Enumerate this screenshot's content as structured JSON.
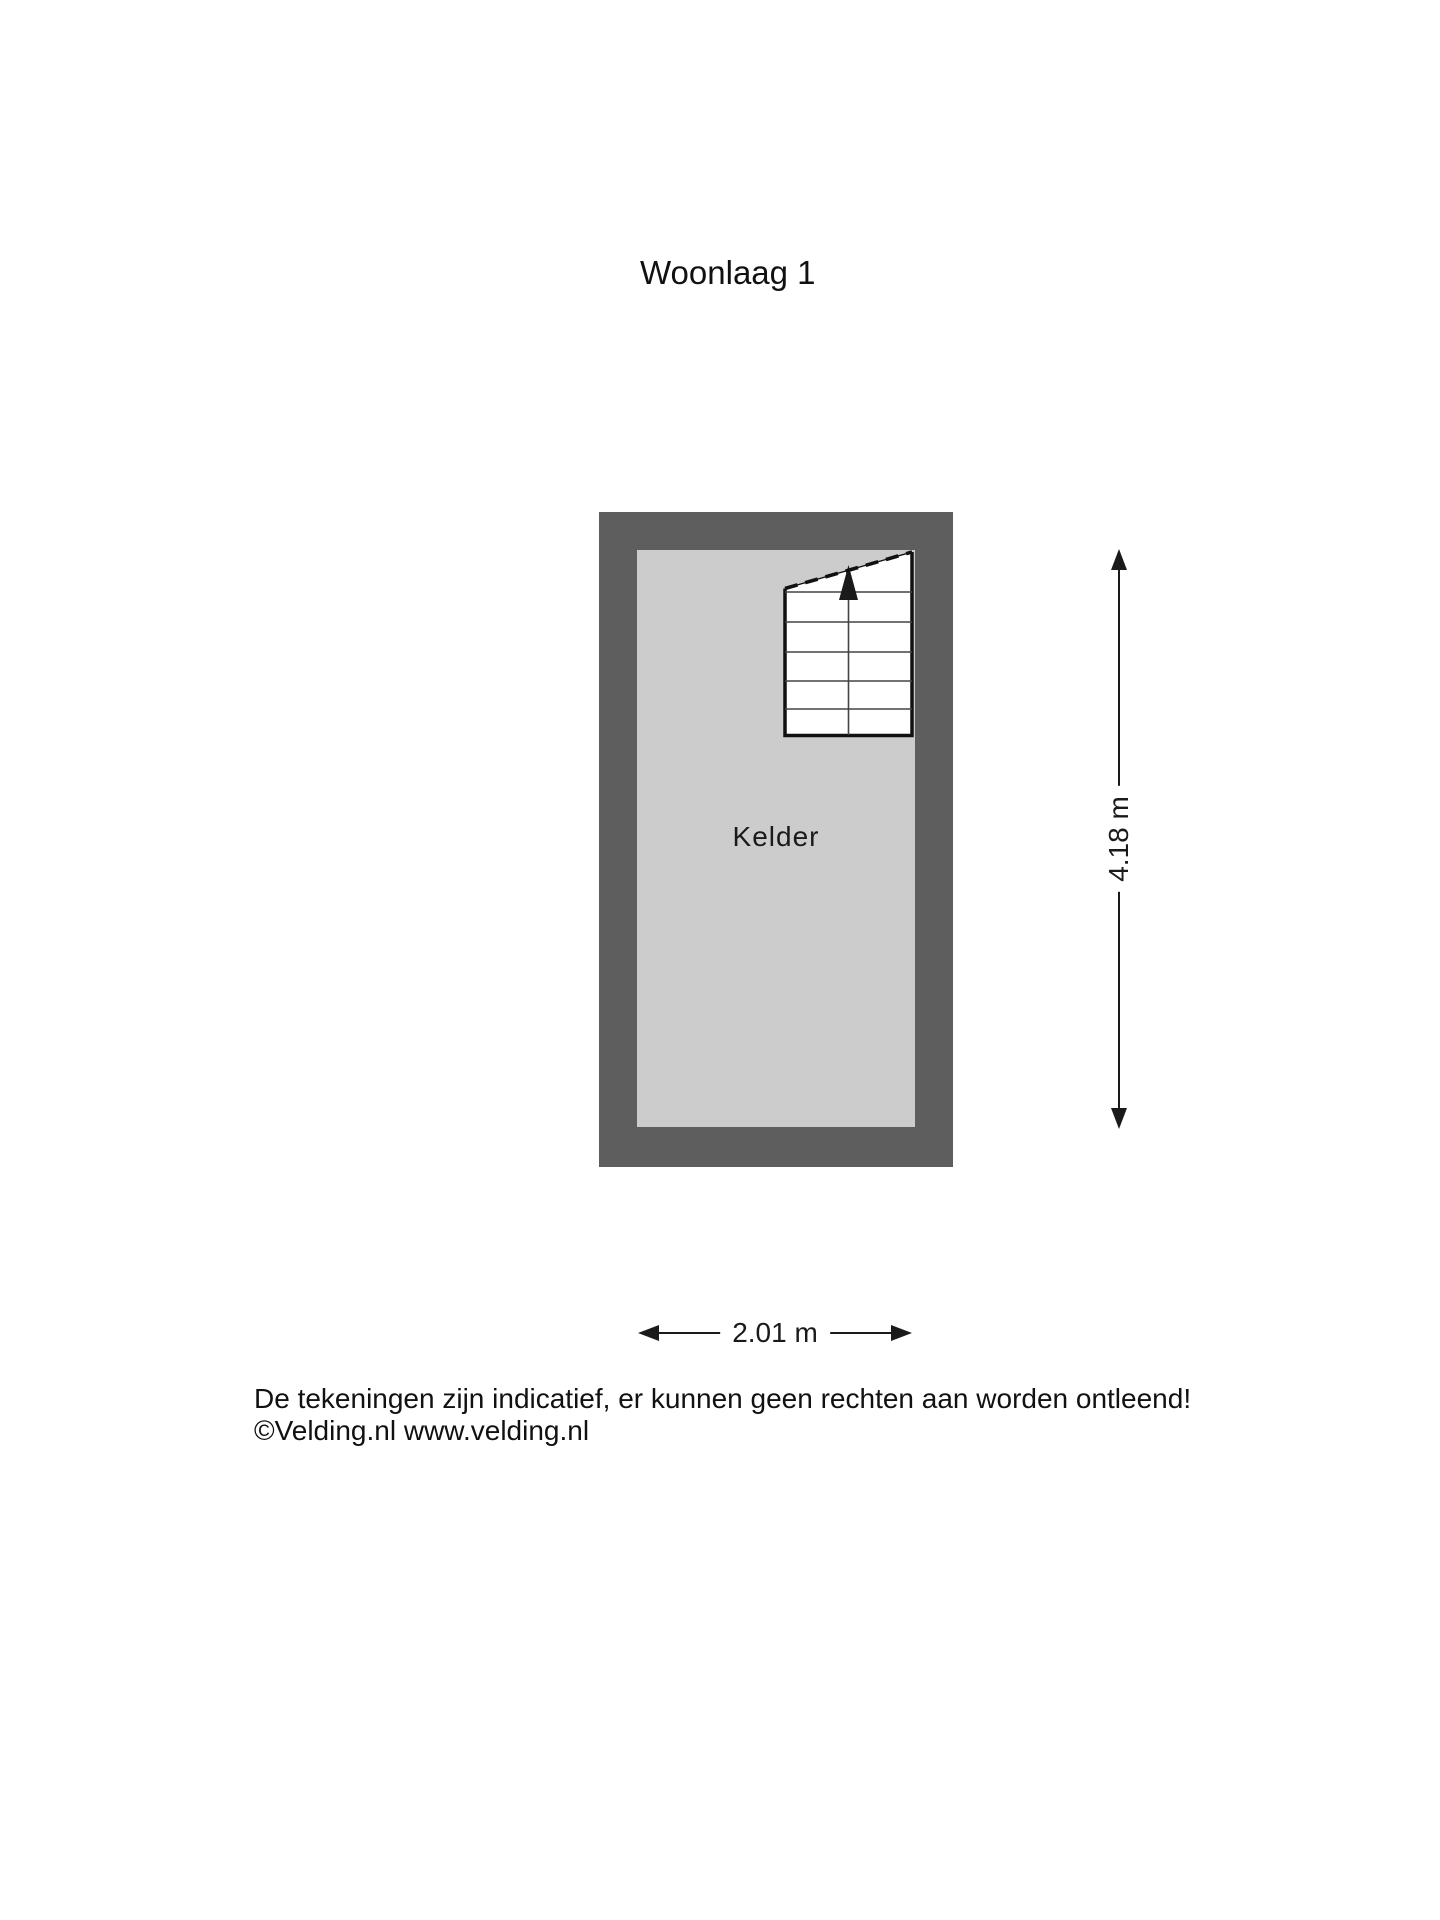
{
  "page": {
    "title": "Woonlaag 1"
  },
  "floorplan": {
    "room_label": "Kelder",
    "features": {
      "staircase": "staircase with up-direction arrow in top-right corner of room"
    },
    "dimensions": {
      "height_label": "4.18 m",
      "width_label": "2.01 m"
    },
    "colors": {
      "wall": "#5e5e5e",
      "floor": "#cccccc",
      "line": "#1a1a1a"
    }
  },
  "footer": {
    "line1": "De tekeningen zijn indicatief, er kunnen geen rechten aan worden ontleend!",
    "line2": "©Velding.nl www.velding.nl"
  }
}
